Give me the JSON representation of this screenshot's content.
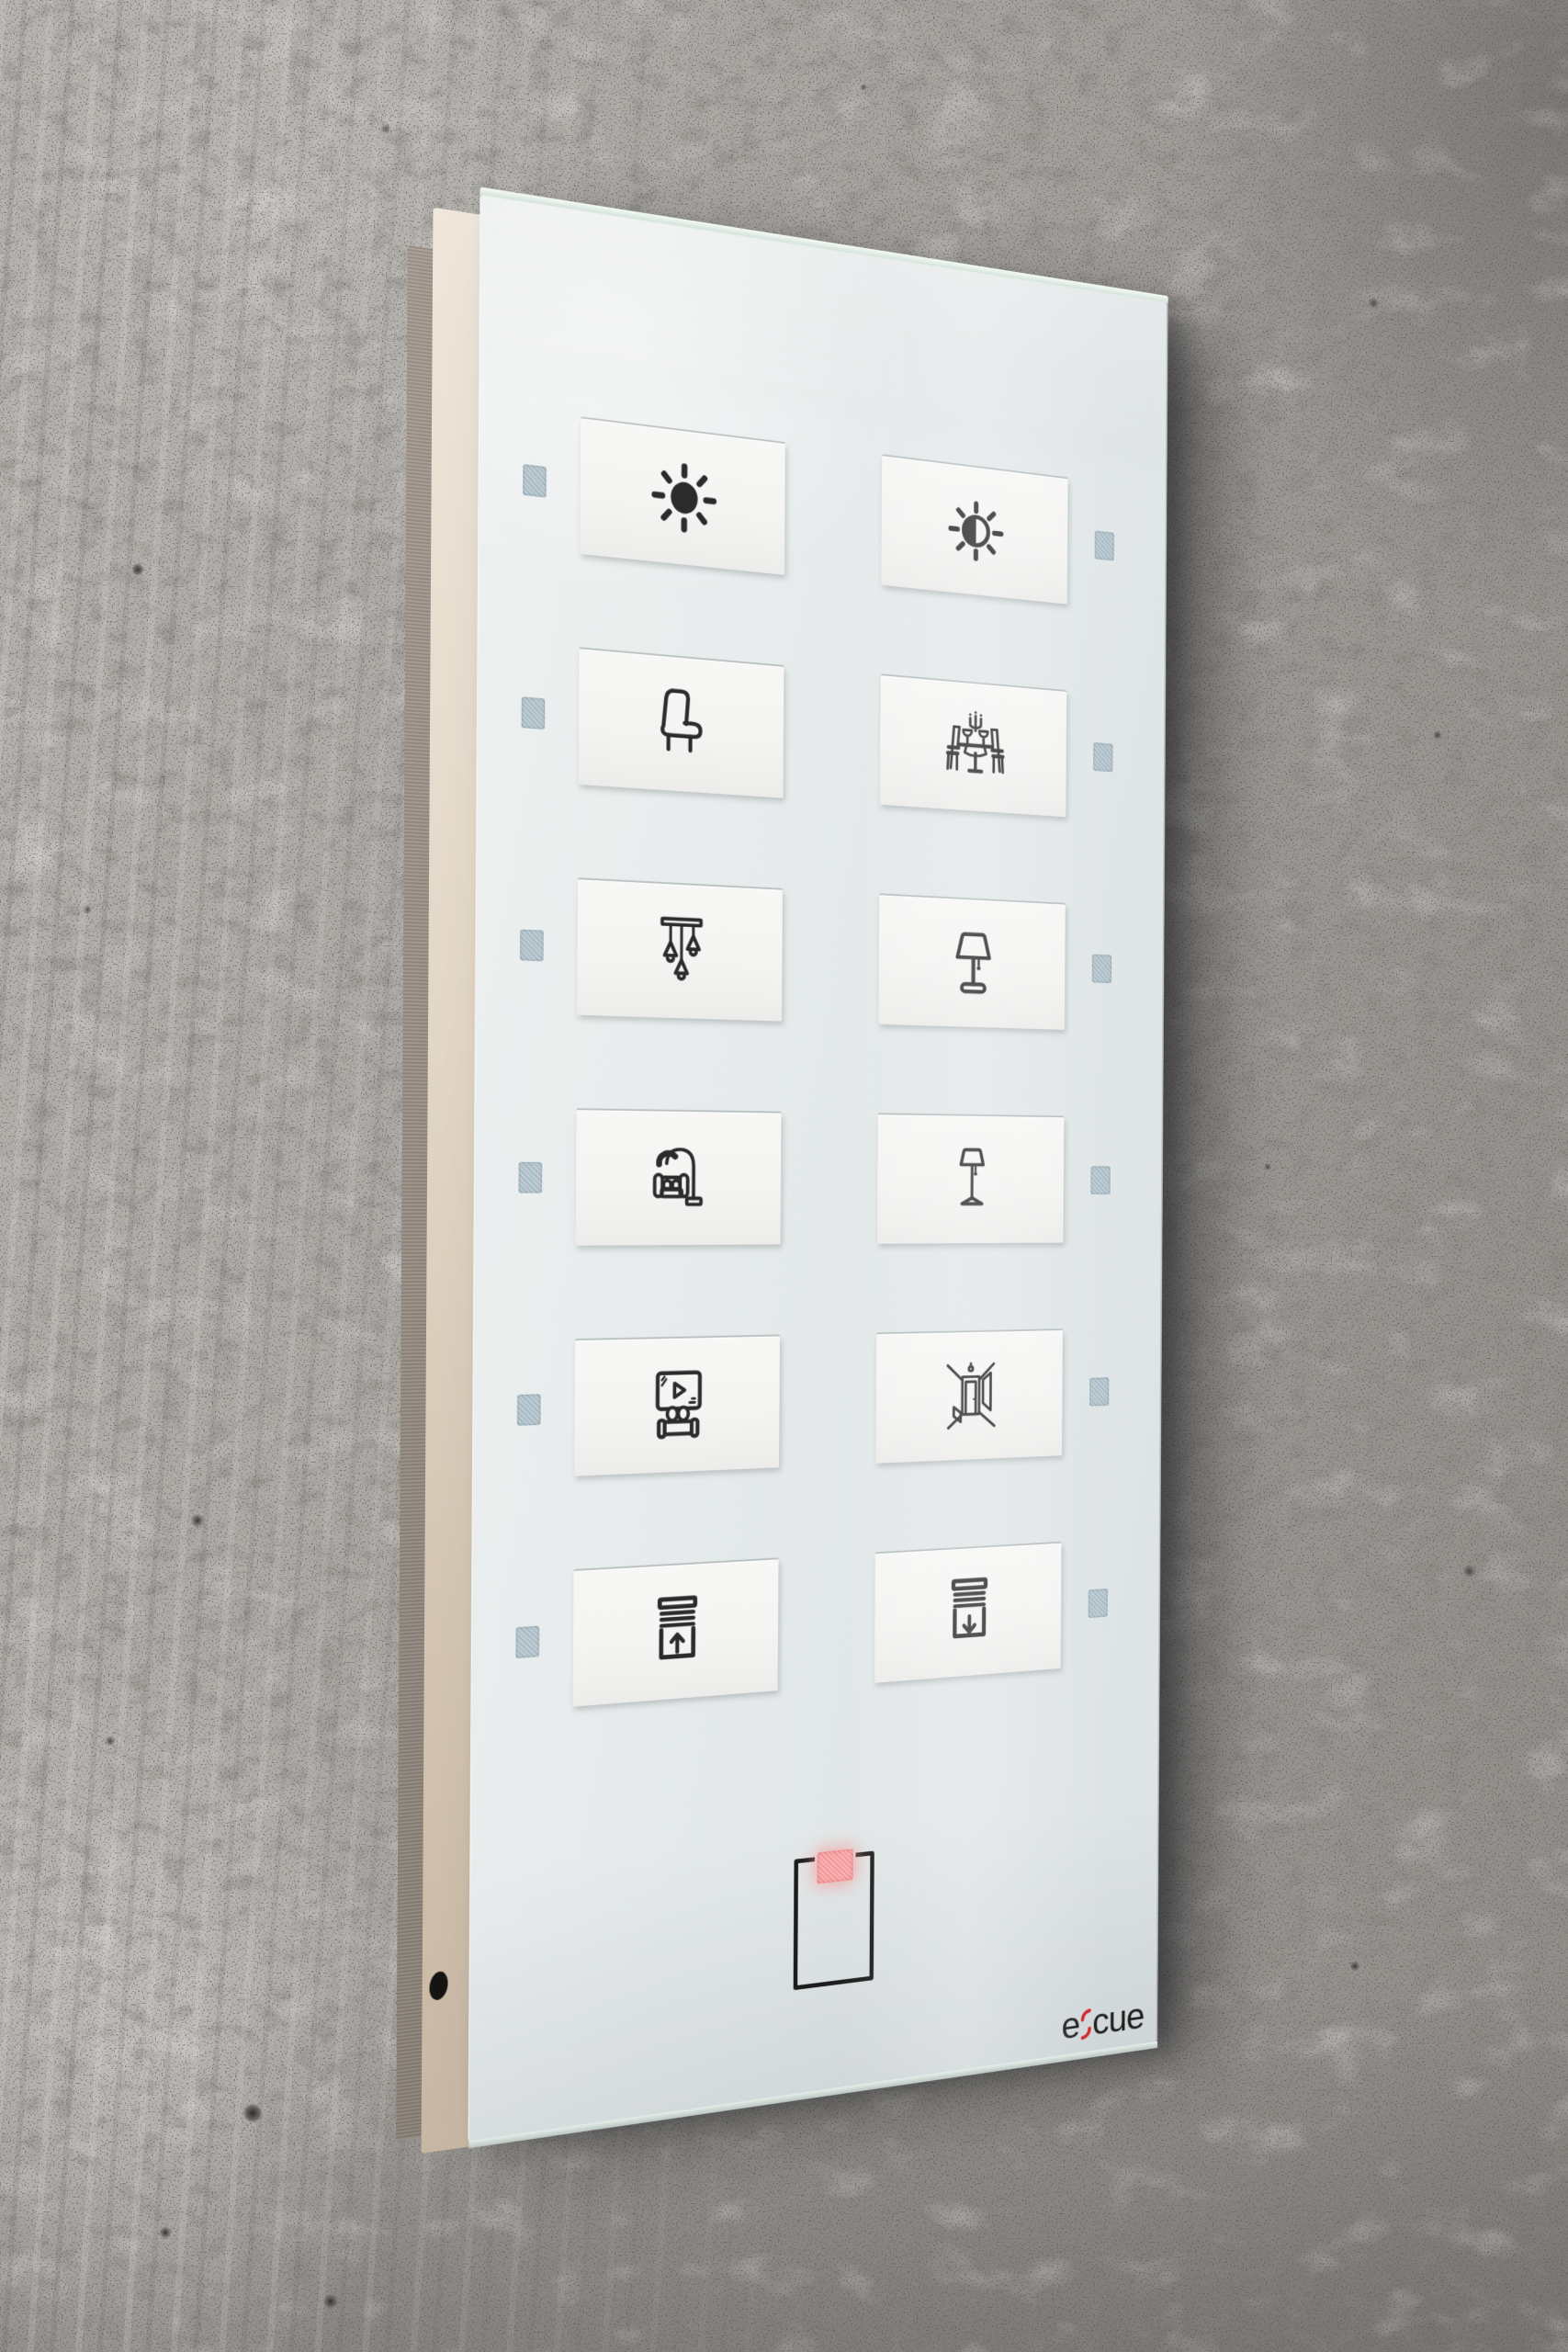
{
  "scene": {
    "description": "Wall-mounted e:cue glass touch control panel on a concrete wall"
  },
  "panel": {
    "buttons": [
      {
        "id": "lights-on",
        "icon": "sun-bright-icon",
        "label": "All lights on - full brightness",
        "row": 0,
        "col": 0
      },
      {
        "id": "lights-dim",
        "icon": "sun-dim-icon",
        "label": "Lights dimmed - half brightness",
        "row": 0,
        "col": 1
      },
      {
        "id": "armchair",
        "icon": "armchair-icon",
        "label": "Armchair scene",
        "row": 1,
        "col": 0
      },
      {
        "id": "dining",
        "icon": "dining-table-icon",
        "label": "Dining scene",
        "row": 1,
        "col": 1
      },
      {
        "id": "pendant",
        "icon": "pendant-lights-icon",
        "label": "Pendant lights",
        "row": 2,
        "col": 0
      },
      {
        "id": "table-lamp",
        "icon": "table-lamp-icon",
        "label": "Table lamp",
        "row": 2,
        "col": 1
      },
      {
        "id": "sofa-lamp",
        "icon": "sofa-reading-lamp-icon",
        "label": "Sofa reading lamp",
        "row": 3,
        "col": 0
      },
      {
        "id": "floor-lamp",
        "icon": "floor-lamp-icon",
        "label": "Floor lamp",
        "row": 3,
        "col": 1
      },
      {
        "id": "media",
        "icon": "tv-media-icon",
        "label": "TV media scene",
        "row": 4,
        "col": 0
      },
      {
        "id": "hallway",
        "icon": "hallway-door-icon",
        "label": "Hallway light",
        "row": 4,
        "col": 1
      },
      {
        "id": "blinds-up",
        "icon": "blinds-up-icon",
        "label": "Blinds up",
        "row": 5,
        "col": 0
      },
      {
        "id": "blinds-down",
        "icon": "blinds-down-icon",
        "label": "Blinds down",
        "row": 5,
        "col": 1
      }
    ],
    "card_reader": {
      "label": "Key card reader",
      "led_on": true
    }
  },
  "logo": {
    "text_left": "e",
    "separator": ":",
    "text_right": "cue",
    "separator_color": "#d2232a",
    "text_color": "#1f1f1d"
  },
  "colors": {
    "led_idle": "#a7bac3",
    "led_active": "#f49597",
    "icon_stroke": "#2b2b2b",
    "glass": "#e3e8e9",
    "button_plate": "#f4f4f2",
    "wall_base": "#a8a5a1",
    "backing_cream": "#e6dccd",
    "backing_metal": "#9a9189"
  }
}
